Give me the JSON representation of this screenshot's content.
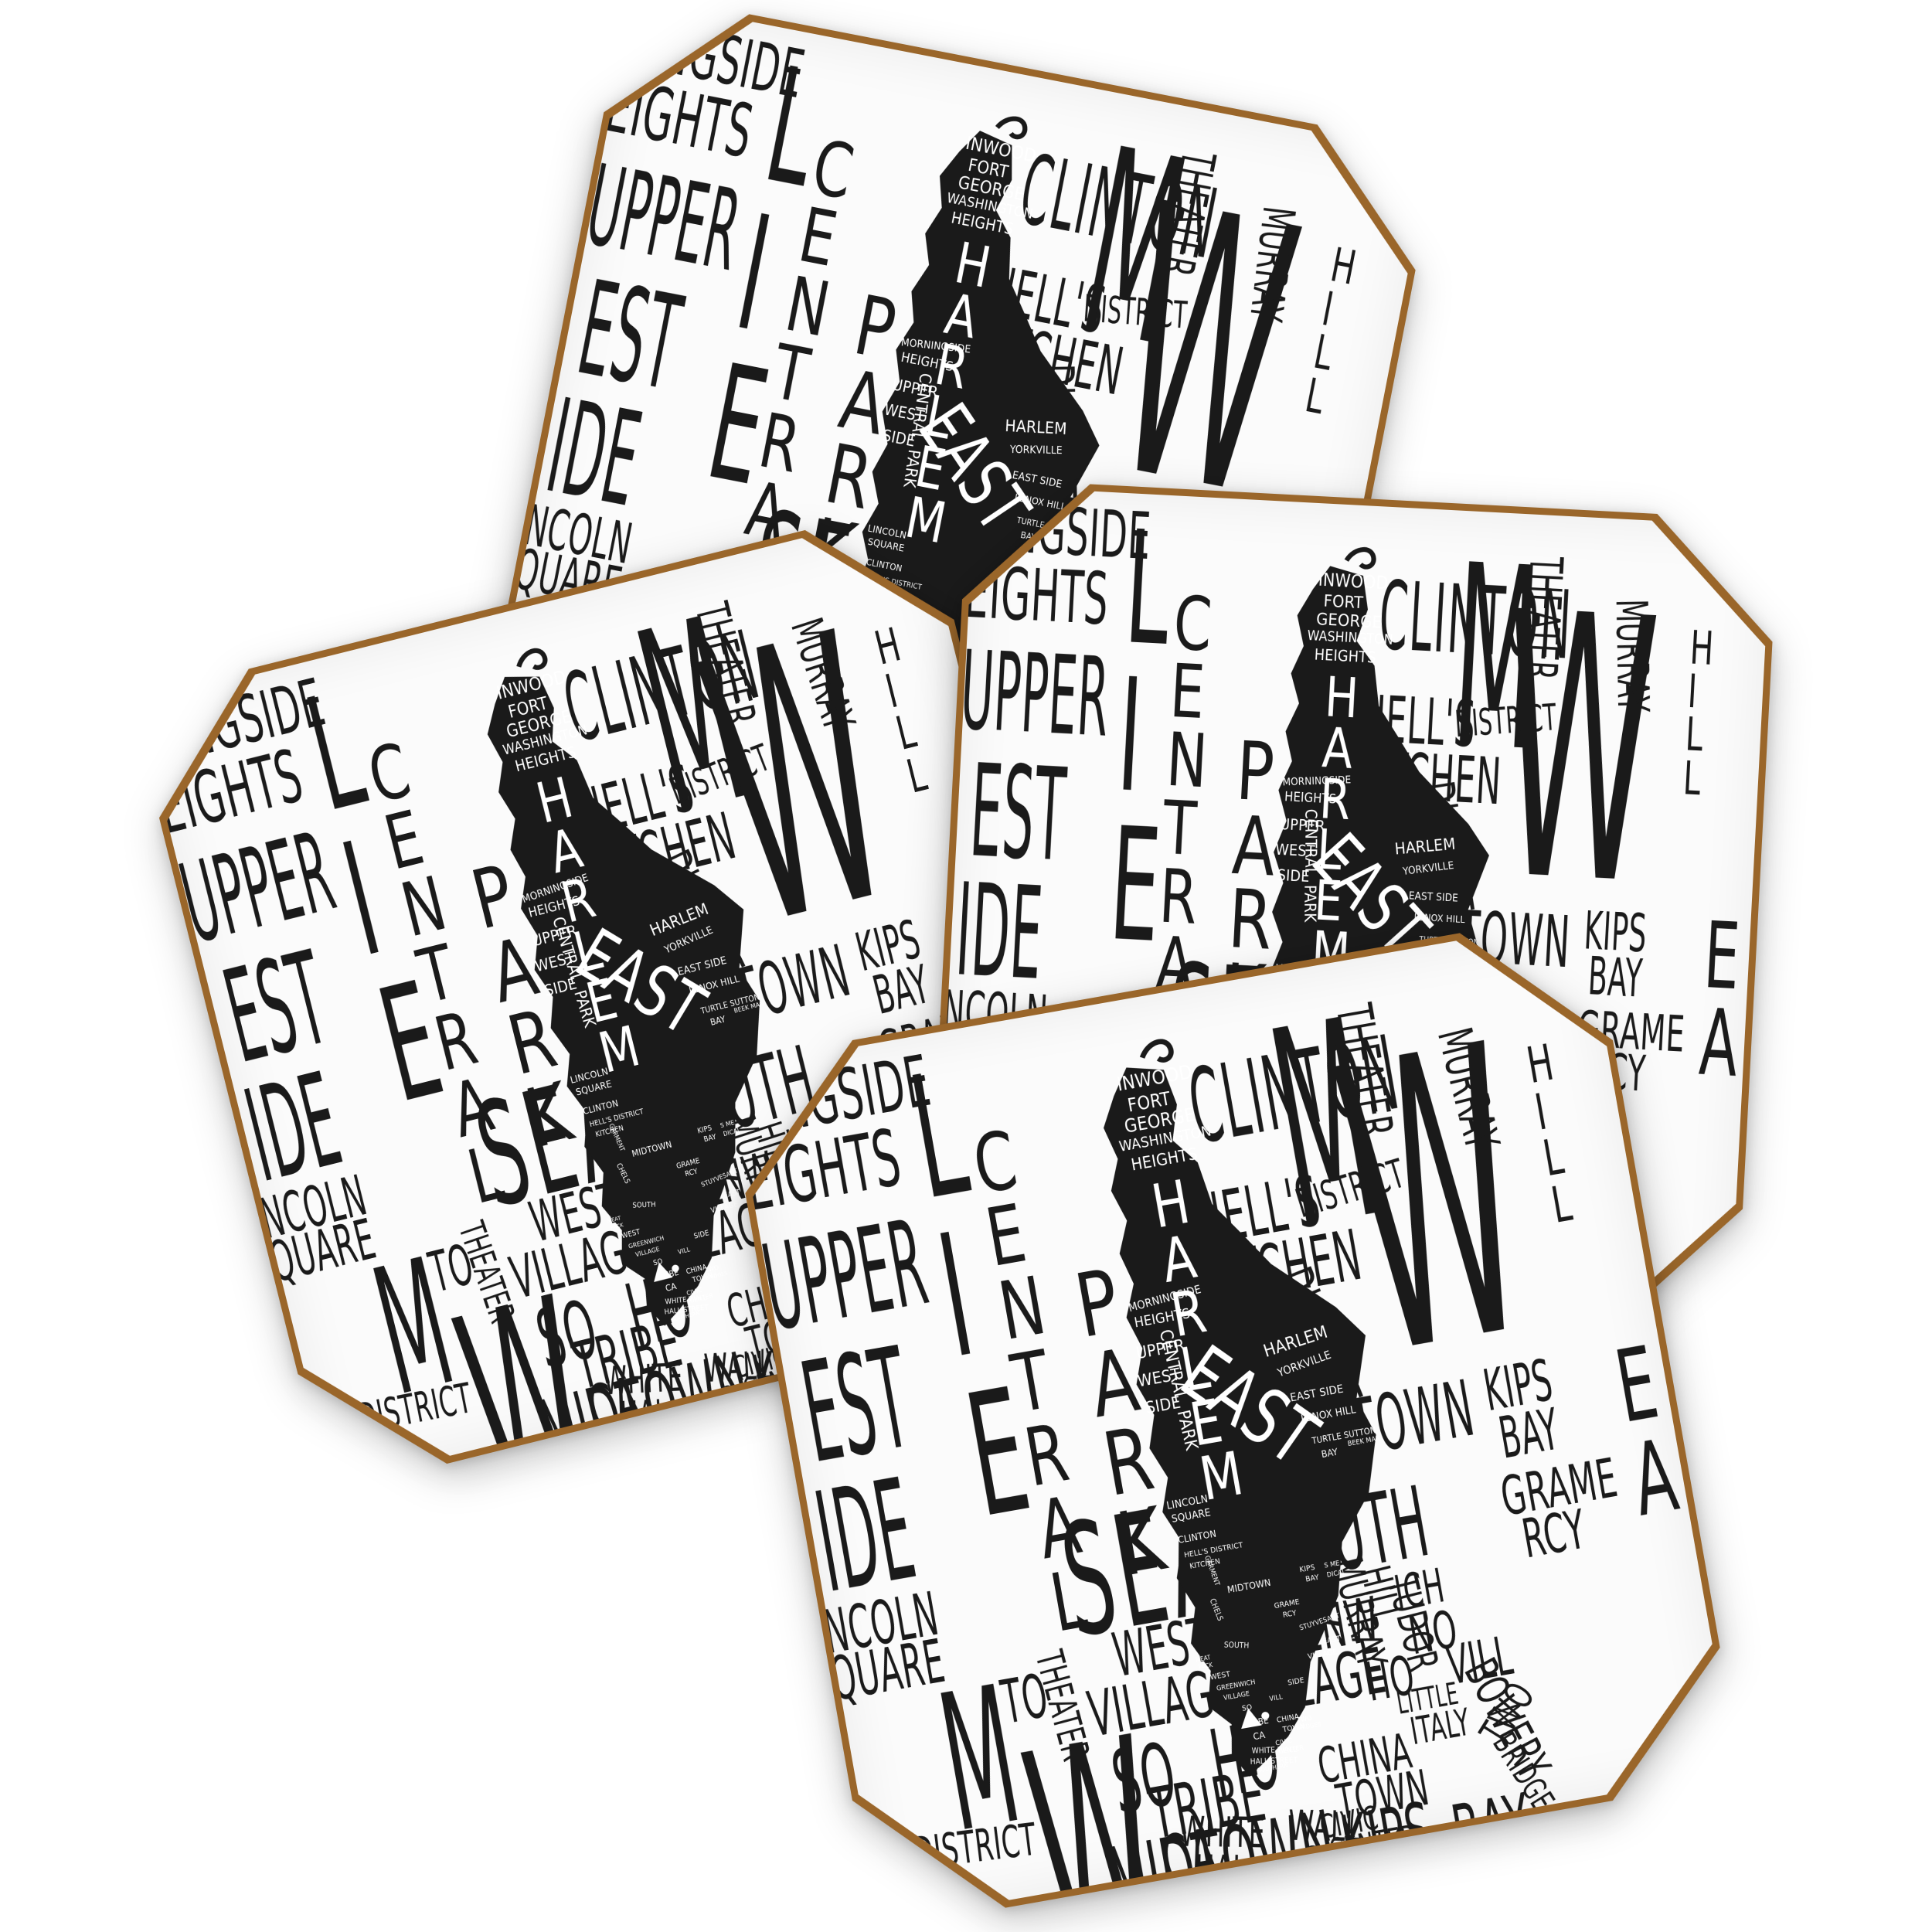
{
  "product": {
    "description": "Set of four octagonal coasters, each printed with an identical black and white hand-lettered typographic map of Manhattan neighborhoods, with a black Manhattan island silhouette filled with small white neighborhood names",
    "item_count": 4,
    "coasters": [
      {
        "position": "back-top"
      },
      {
        "position": "left"
      },
      {
        "position": "right"
      },
      {
        "position": "front-bottom"
      }
    ],
    "colors": {
      "background": "#ffffff",
      "surface": "#fbfbfb",
      "ink": "#1a1a1a",
      "cork_edge": "#9a662a",
      "label_white": "#ffffff"
    }
  },
  "design": {
    "background_labels": [
      "NGSIDE",
      "EIGHTS",
      "UPPER",
      "EST",
      "IDE",
      "NCOLN",
      "QUARE",
      "LIE",
      "CENTRAL",
      "PARK",
      "CLINTON",
      "M",
      "THEATER",
      "HELL'S",
      "DISTRICT",
      "KITCHEN",
      "GARMENT",
      "DISTRICT",
      "W",
      "MURRAY",
      "HILL",
      "MIDTOWN",
      "KIPS",
      "BAY",
      "SEA",
      "SOUTH",
      "GRAME",
      "RCY",
      "EA",
      "WEST",
      "GREENW",
      "ICH",
      "VILLAGE",
      "VILLAGE",
      "NO",
      "HO",
      "VILL",
      "SO",
      "HO",
      "LITTLE",
      "ITALY",
      "BOWERY",
      "TRIBE",
      "CA",
      "CHINA",
      "TOWN",
      "TWO",
      "BRIDGES",
      "CIVIC",
      "CENTER",
      "WHITE",
      "WALL",
      "HALL",
      "STREET",
      "SOUTHERN",
      "M",
      "TO",
      "THEATER",
      "DISTRICT",
      "MENT",
      "W",
      "BAY",
      "MURRAY",
      "HILL",
      "TUDOR",
      "MIDTOWN",
      "KIPS",
      "BAY"
    ],
    "island_labels": [
      "INWOOD",
      "FORT",
      "GEORGE",
      "WASHINGTON",
      "HEIGHTS",
      "HARLEM",
      "EAST",
      "MORNINGSIDE",
      "HEIGHTS",
      "UPPER",
      "WEST",
      "SIDE",
      "CENTRAL",
      "PARK",
      "HARLEM",
      "YORKVILLE",
      "EAST SIDE",
      "LENOX HILL",
      "TURTLE SUTTON",
      "BAY",
      "BEEK MAN",
      "LINCOLN",
      "SQUARE",
      "CLINTON",
      "HELL'S DISTRICT",
      "KITCHEN",
      "GARMENT",
      "MIDTOWN",
      "KIPS",
      "BAY",
      "S ME",
      "DICAL",
      "GRAME",
      "RCY",
      "STUYVESANT",
      "EAST",
      "VILLAGE",
      "CHELS",
      "SOUTH",
      "WEST",
      "GREENWICH",
      "VILLAGE",
      "MEAT",
      "PACK",
      "SO",
      "VILL",
      "SIDE",
      "TRIBE",
      "CA",
      "CHINA",
      "TOWN",
      "TWO",
      "BRIDGES",
      "CIVIC",
      "CENTER",
      "WHITE WALL",
      "HALL STREET",
      "SOUTHERN"
    ]
  }
}
